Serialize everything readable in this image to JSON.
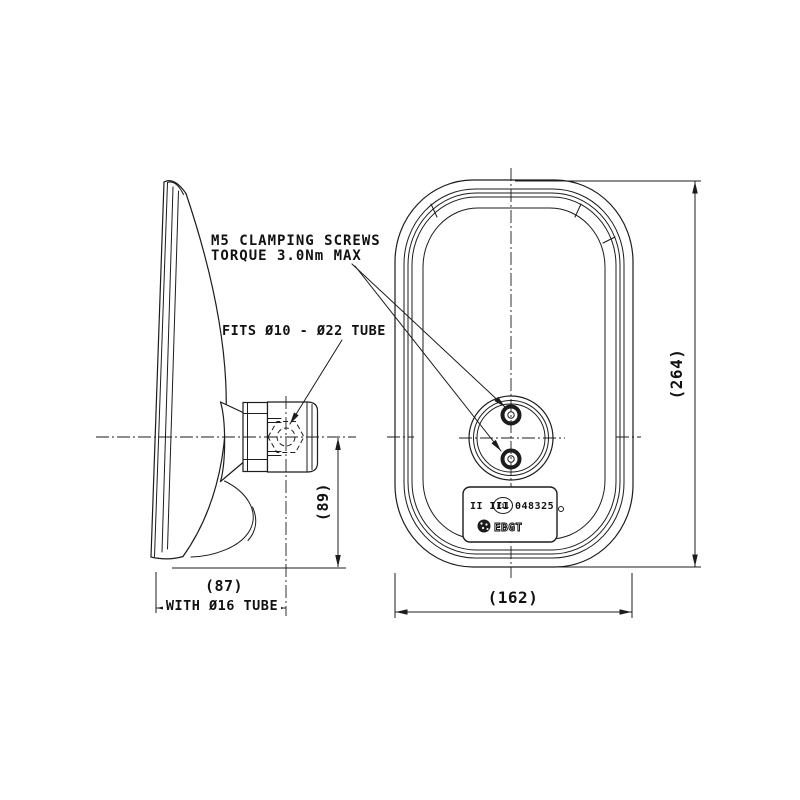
{
  "drawing": {
    "annotations": {
      "clamp_note_line1": "M5 CLAMPING SCREWS",
      "clamp_note_line2": "TORQUE 3.0Nm MAX",
      "tube_fit_note": "FITS Ø10 - Ø22 TUBE",
      "with_tube_note": "WITH Ø16 TUBE"
    },
    "dimensions": {
      "overall_height": "(264)",
      "overall_width": "(162)",
      "overall_depth": "(87)",
      "arm_drop": "(89)"
    },
    "approval_label": {
      "mirror_classes": "II III",
      "e_mark": "E11",
      "approval_number": "048325",
      "brand": "EBGT"
    },
    "line_color": "#1c1c1c",
    "background_color": "#ffffff"
  }
}
